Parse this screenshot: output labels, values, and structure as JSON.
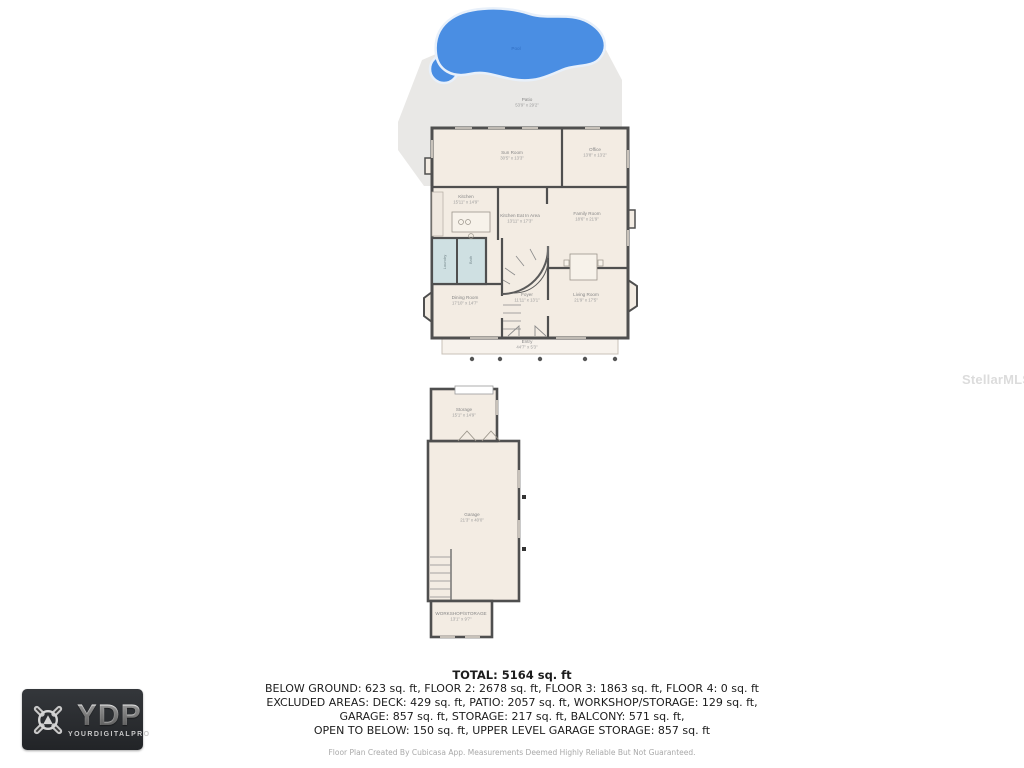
{
  "watermark": "StellarMLS",
  "site": {
    "pool_label": "Pool",
    "patio": {
      "name": "Patio",
      "dims": "53'9\" x 29'2\""
    }
  },
  "floor2": {
    "rooms": {
      "sun_room": {
        "name": "Sun Room",
        "dims": "30'5\" x 13'3\""
      },
      "office": {
        "name": "Office",
        "dims": "13'8\" x 13'2\""
      },
      "kitchen": {
        "name": "Kitchen",
        "dims": "15'11\" x 14'9\""
      },
      "kitchen_eat_in": {
        "name": "Kitchen Eat In Area",
        "dims": "13'11\" x 17'3\""
      },
      "family_room": {
        "name": "Family Room",
        "dims": "18'6\" x 21'9\""
      },
      "laundry": {
        "name": "Laundry"
      },
      "bath": {
        "name": "Bath"
      },
      "dining_room": {
        "name": "Dining Room",
        "dims": "17'10\" x 14'7\""
      },
      "foyer": {
        "name": "Foyer",
        "dims": "11'11\" x 13'1\""
      },
      "living_room": {
        "name": "Living Room",
        "dims": "21'9\" x 17'5\""
      },
      "entry": {
        "name": "Entry",
        "dims": "44'7\" x 5'3\""
      }
    }
  },
  "garage_level": {
    "rooms": {
      "storage": {
        "name": "Storage",
        "dims": "15'1\" x 14'9\""
      },
      "garage": {
        "name": "Garage",
        "dims": "21'3\" x 40'0\""
      },
      "workshop_storage": {
        "name": "WORKSHOP/STORAGE",
        "dims": "13'1\" x 9'7\""
      }
    }
  },
  "summary": {
    "total": "TOTAL: 5164 sq. ft",
    "lines": [
      "BELOW GROUND: 623 sq. ft, FLOOR 2: 2678 sq. ft, FLOOR 3: 1863 sq. ft, FLOOR 4: 0 sq. ft",
      "EXCLUDED AREAS: DECK: 429 sq. ft, PATIO: 2057 sq. ft, WORKSHOP/STORAGE: 129 sq. ft,",
      "GARAGE: 857 sq. ft, STORAGE: 217 sq. ft, BALCONY: 571 sq. ft,",
      "OPEN TO BELOW: 150 sq. ft, UPPER LEVEL GARAGE STORAGE: 857 sq. ft"
    ],
    "disclaimer": "Floor Plan Created By Cubicasa App. Measurements Deemed Highly Reliable But Not Guaranteed."
  },
  "logo": {
    "abbr": "YDP",
    "name": "YOURDIGITALPRO"
  },
  "colors": {
    "pool_blue": "#4a8ee3",
    "patio_gray": "#e9e8e6",
    "wall_gray": "#4f4f4f",
    "floor_cream": "#f3ece3",
    "wet_room_blue": "#cfe0e2"
  }
}
